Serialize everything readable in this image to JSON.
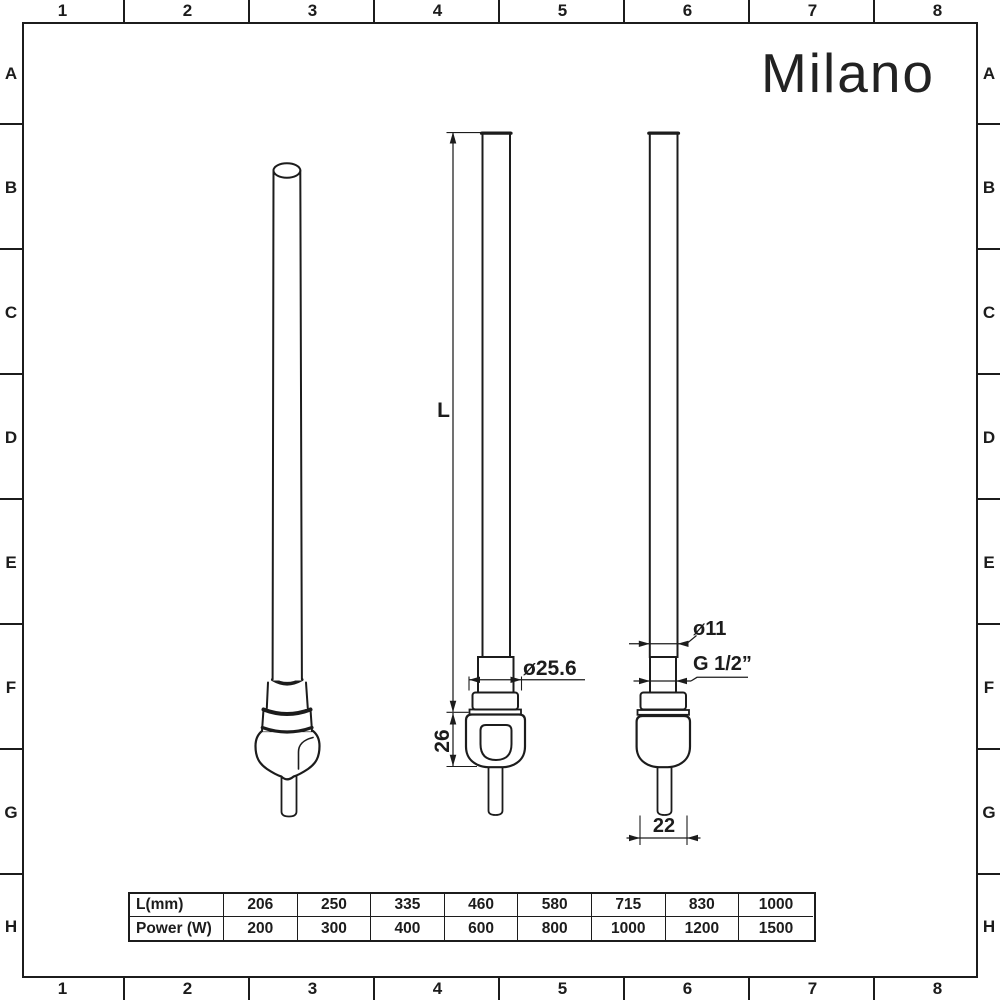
{
  "brand": "Milano",
  "grid": {
    "cols": [
      "1",
      "2",
      "3",
      "4",
      "5",
      "6",
      "7",
      "8"
    ],
    "rows": [
      "A",
      "B",
      "C",
      "D",
      "E",
      "F",
      "G",
      "H"
    ]
  },
  "dimensions": {
    "length": "L",
    "fitting_diameter": "ø25.6",
    "body_height": "26",
    "element_diameter": "ø11",
    "thread_size": "G 1/2”",
    "body_width": "22"
  },
  "table": {
    "rows": [
      {
        "label": "L(mm)",
        "values": [
          "206",
          "250",
          "335",
          "460",
          "580",
          "715",
          "830",
          "1000"
        ]
      },
      {
        "label": "Power (W)",
        "values": [
          "200",
          "300",
          "400",
          "600",
          "800",
          "1000",
          "1200",
          "1500"
        ]
      }
    ]
  }
}
